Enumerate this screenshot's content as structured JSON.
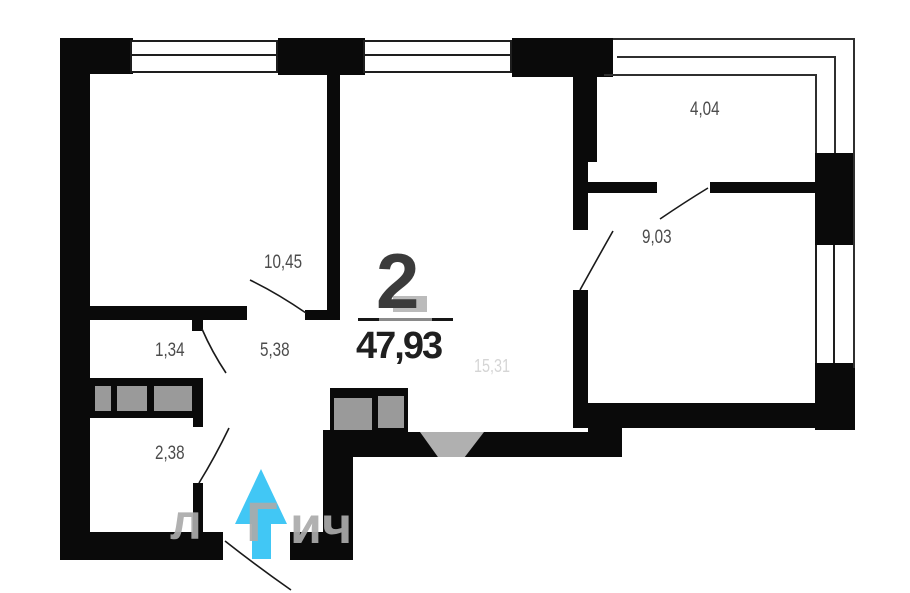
{
  "plan_title": {
    "rooms_count": "2",
    "total_area": "47,93"
  },
  "rooms": {
    "bedroom": {
      "label": "10,45"
    },
    "living": {
      "label": "15,31"
    },
    "room_second": {
      "label": "9,03"
    },
    "hallway": {
      "label": "5,38"
    },
    "bathroom": {
      "label": "2,38"
    },
    "closet": {
      "label": "1,34"
    },
    "balcony": {
      "label": "4,04"
    }
  },
  "watermark": {
    "fragment_1": "л",
    "fragment_2": "Г",
    "fragment_3": "ич"
  },
  "colors": {
    "wall": "#0a0a0a",
    "window_line": "#1e1e1e",
    "furniture_fill": "#9a9a9a",
    "vent_fill": "#b0b0b0",
    "entrance_arrow": "#41c7f5",
    "label_text": "#4c4c4c",
    "living_label_text": "#d5d5d5",
    "title_text": "#3b3b3b",
    "area_text": "#1f1f1f",
    "watermark_text": "#ababab"
  }
}
